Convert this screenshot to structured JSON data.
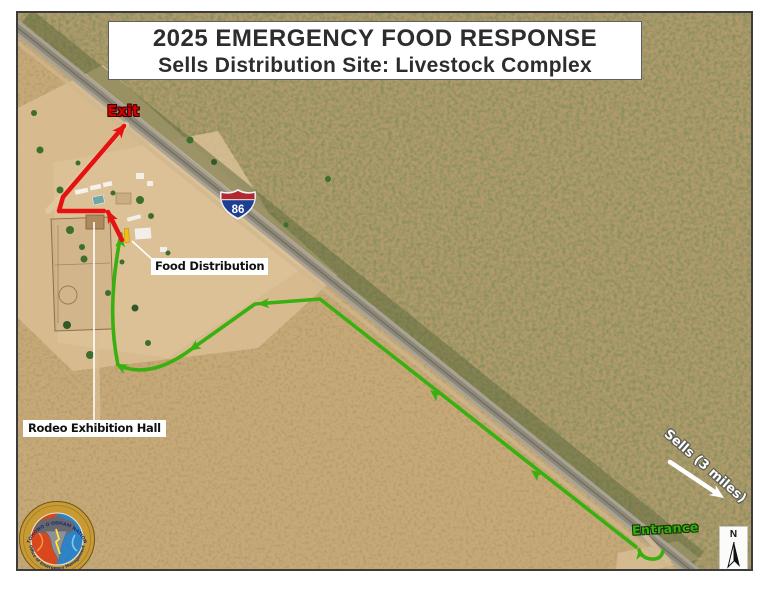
{
  "title": {
    "line1": "2025 EMERGENCY FOOD RESPONSE",
    "line2": "Sells Distribution Site: Livestock Complex"
  },
  "labels": {
    "exit": "Exit",
    "entrance": "Entrance",
    "food_distribution": "Food Distribution",
    "rodeo_hall": "Rodeo Exhibition Hall",
    "sells_distance": "Sells (3 miles)",
    "north": "N",
    "highway_number": "86"
  },
  "logo": {
    "ring_top": "TOHONO O'ODHAM NATION",
    "ring_bottom": "Office of Emergency Management"
  },
  "colors": {
    "route_entry": "#3aaf10",
    "route_exit": "#e61212",
    "exit_text": "#d60000",
    "entrance_text": "#36b00c",
    "shield_blue": "#1e3e92",
    "shield_red": "#b3282d"
  }
}
